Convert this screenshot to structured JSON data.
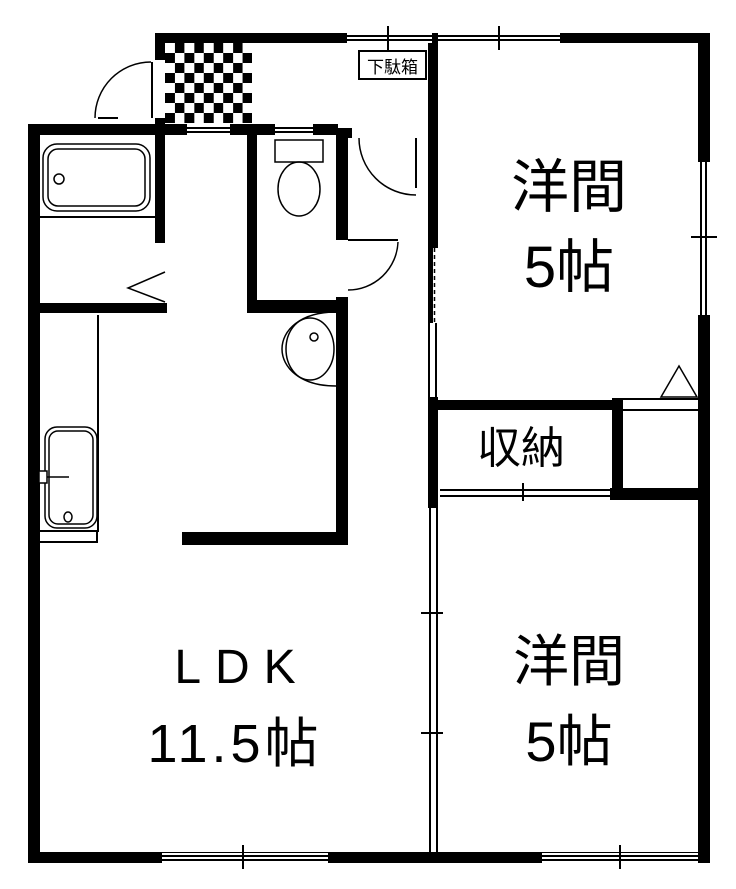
{
  "floorplan": {
    "rooms": {
      "western_top": {
        "name": "洋間",
        "size": "5帖"
      },
      "western_bottom": {
        "name": "洋間",
        "size": "5帖"
      },
      "ldk": {
        "name": "LDK",
        "size": "11.5帖"
      },
      "storage": {
        "name": "収納"
      },
      "shoe_cabinet": {
        "name": "下駄箱"
      }
    },
    "fixtures": {
      "bathtub": "bathtub",
      "toilet": "toilet",
      "washbasin": "washbasin",
      "kitchen_sink": "kitchen-sink",
      "entrance_tile": "genkan-tile-floor"
    },
    "colors": {
      "wall": "#000000",
      "background": "#ffffff"
    }
  }
}
